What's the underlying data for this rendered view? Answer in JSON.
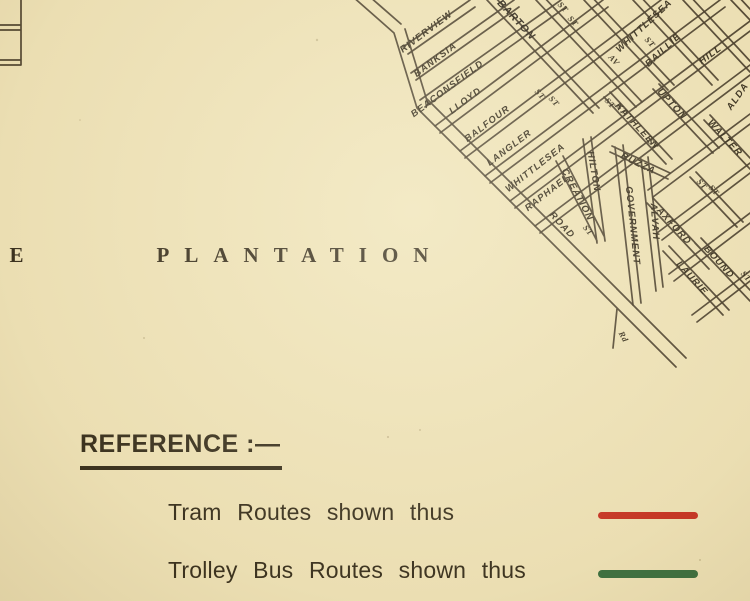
{
  "map": {
    "region": {
      "prefix_letter": "E",
      "name": "PLANTATION"
    },
    "labels": [
      {
        "t": "E",
        "x": 24,
        "y": 262,
        "r": 0,
        "c": "region"
      },
      {
        "t": "PLANTATION",
        "x": 300,
        "y": 262,
        "r": 0,
        "c": "region"
      },
      {
        "t": "RIVERVIEW",
        "x": 428,
        "y": 34,
        "r": -37
      },
      {
        "t": "BANKSIA",
        "x": 437,
        "y": 62,
        "r": -37
      },
      {
        "t": "BEACONSFIELD",
        "x": 449,
        "y": 91,
        "r": -37
      },
      {
        "t": "LLOYD",
        "x": 467,
        "y": 103,
        "r": -37
      },
      {
        "t": "BALFOUR",
        "x": 489,
        "y": 126,
        "r": -37
      },
      {
        "t": "LANGLER",
        "x": 511,
        "y": 150,
        "r": -37
      },
      {
        "t": "WHITTLESEA",
        "x": 537,
        "y": 170,
        "r": -38
      },
      {
        "t": "RAPHAEL",
        "x": 549,
        "y": 195,
        "r": -38
      },
      {
        "t": "WHITTLESEA",
        "x": 646,
        "y": 28,
        "r": -43
      },
      {
        "t": "BAILLIE",
        "x": 665,
        "y": 52,
        "r": -43
      },
      {
        "t": "HILL",
        "x": 712,
        "y": 57,
        "r": -36
      },
      {
        "t": "ALDA",
        "x": 740,
        "y": 98,
        "r": -55
      },
      {
        "t": "BARTON",
        "x": 514,
        "y": 22,
        "r": 47,
        "c": "street-bold"
      },
      {
        "t": "KATHLEEN",
        "x": 635,
        "y": 128,
        "r": 47
      },
      {
        "t": "UPTON",
        "x": 670,
        "y": 106,
        "r": 47
      },
      {
        "t": "WALTER",
        "x": 723,
        "y": 140,
        "r": 47
      },
      {
        "t": "AXFORD",
        "x": 672,
        "y": 228,
        "r": 48
      },
      {
        "t": "LAURIE",
        "x": 690,
        "y": 280,
        "r": 48
      },
      {
        "t": "BOUND",
        "x": 717,
        "y": 264,
        "r": 48
      },
      {
        "t": "HILTON",
        "x": 591,
        "y": 172,
        "r": 80
      },
      {
        "t": "CREATION",
        "x": 575,
        "y": 196,
        "r": 62
      },
      {
        "t": "BUZZA",
        "x": 637,
        "y": 166,
        "r": 26
      },
      {
        "t": "GOVERNMENT",
        "x": 630,
        "y": 226,
        "r": 84
      },
      {
        "t": "ALVAH",
        "x": 652,
        "y": 222,
        "r": 86
      },
      {
        "t": "ROAD",
        "x": 560,
        "y": 227,
        "r": 47
      },
      {
        "t": "ST",
        "x": 561,
        "y": 9,
        "r": 47,
        "c": "st"
      },
      {
        "t": "ST",
        "x": 571,
        "y": 23,
        "r": 47,
        "c": "st"
      },
      {
        "t": "ST",
        "x": 538,
        "y": 96,
        "r": 47,
        "c": "st"
      },
      {
        "t": "ST",
        "x": 552,
        "y": 103,
        "r": 47,
        "c": "st"
      },
      {
        "t": "AV",
        "x": 612,
        "y": 62,
        "r": 47,
        "c": "st"
      },
      {
        "t": "ST",
        "x": 648,
        "y": 44,
        "r": 47,
        "c": "st"
      },
      {
        "t": "ST",
        "x": 608,
        "y": 105,
        "r": 47,
        "c": "st"
      },
      {
        "t": "ST",
        "x": 620,
        "y": 111,
        "r": 47,
        "c": "st"
      },
      {
        "t": "ST",
        "x": 651,
        "y": 146,
        "r": 47,
        "c": "st"
      },
      {
        "t": "ST",
        "x": 700,
        "y": 186,
        "r": 47,
        "c": "st"
      },
      {
        "t": "ST",
        "x": 712,
        "y": 192,
        "r": 47,
        "c": "st"
      },
      {
        "t": "ST",
        "x": 586,
        "y": 232,
        "r": 50,
        "c": "st"
      },
      {
        "t": "ST",
        "x": 744,
        "y": 278,
        "r": 48,
        "c": "st"
      },
      {
        "t": "Rd",
        "x": 621,
        "y": 338,
        "r": 62,
        "c": "st"
      }
    ]
  },
  "reference": {
    "heading": "REFERENCE :—",
    "items": [
      {
        "label": "Tram Routes shown thus",
        "color": "#c4291d"
      },
      {
        "label": "Trolley Bus Routes shown thus",
        "color": "#30693c"
      }
    ]
  },
  "colors": {
    "paper": "#eee3ba",
    "ink": "#3a3022"
  }
}
